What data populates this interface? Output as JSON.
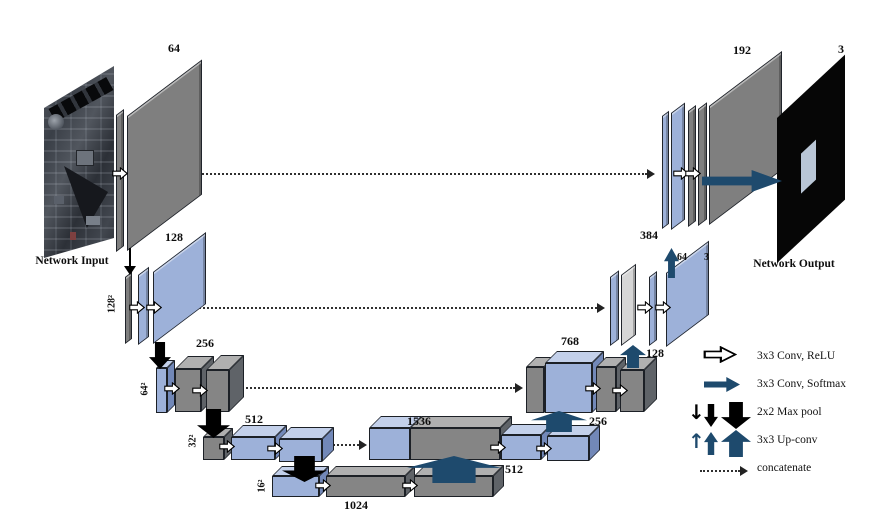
{
  "figure": {
    "input_label": "Network Input",
    "output_label": "Network Output"
  },
  "encoder": {
    "levels": [
      {
        "channels": "64",
        "size": ""
      },
      {
        "channels": "128",
        "size": "128²"
      },
      {
        "channels": "256",
        "size": "64²"
      },
      {
        "channels": "512",
        "size": "32²"
      },
      {
        "channels": "1024",
        "size": "16²"
      }
    ]
  },
  "decoder": {
    "levels": [
      {
        "concat": "1536",
        "upconv_label": "512"
      },
      {
        "concat": "768",
        "upconv_label": "256"
      },
      {
        "concat": "384",
        "upconv_label": "128",
        "conv_channels": "64",
        "out_channels": "3"
      },
      {
        "concat": "192"
      }
    ],
    "output_channels": "3"
  },
  "legend": {
    "items": [
      {
        "name": "conv-relu",
        "label": "3x3 Conv, ReLU"
      },
      {
        "name": "conv-softmax",
        "label": "3x3 Conv, Softmax"
      },
      {
        "name": "maxpool",
        "label": "2x2 Max pool"
      },
      {
        "name": "upconv",
        "label": "3x3 Up-conv"
      },
      {
        "name": "concatenate",
        "label": "concatenate"
      }
    ]
  },
  "icons": {
    "thin_down_arrow": "↓",
    "thin_up_arrow": "↑"
  },
  "colors": {
    "feature_gray": "#7f7f7f",
    "feature_blue": "#9db1d9",
    "feature_light_gray": "#d6d6d6",
    "arrow_dark_blue": "#1e4a6d",
    "arrow_black": "#000000"
  }
}
